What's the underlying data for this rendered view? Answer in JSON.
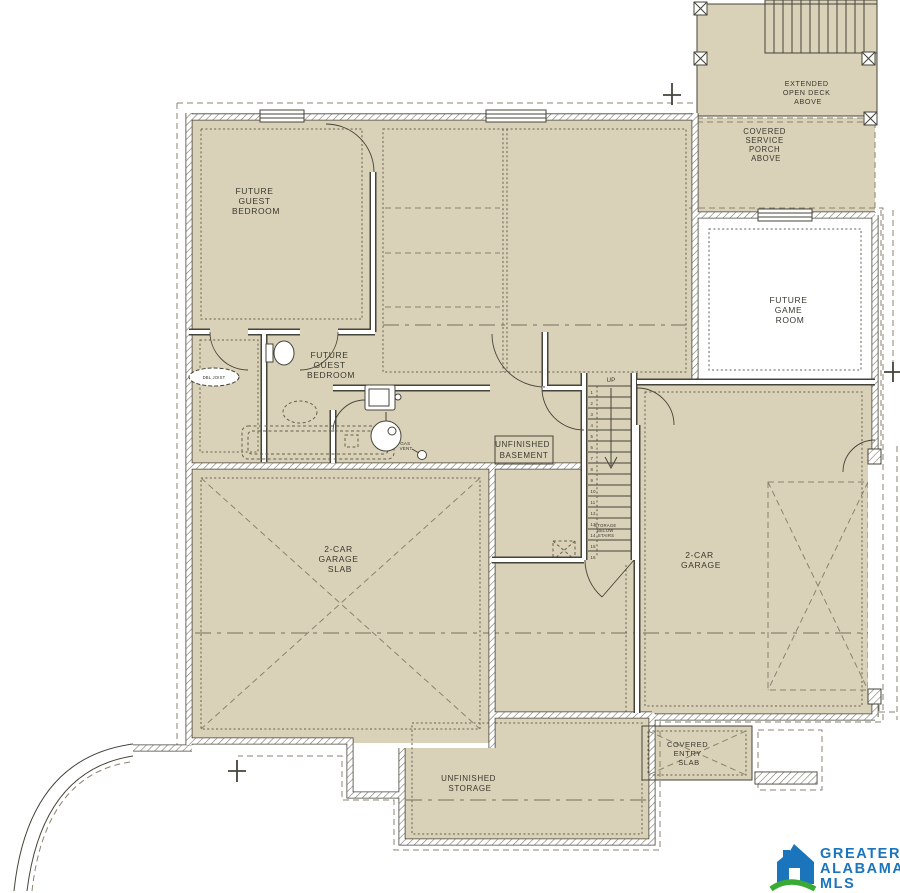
{
  "labels": {
    "guest_bedroom_upper": [
      "FUTURE",
      "GUEST",
      "BEDROOM"
    ],
    "guest_bedroom_lower": [
      "FUTURE",
      "GUEST",
      "BEDROOM"
    ],
    "unfinished_basement": [
      "UNFINISHED",
      "BASEMENT"
    ],
    "future_game_room": [
      "FUTURE",
      "GAME",
      "ROOM"
    ],
    "extended_open_deck": [
      "EXTENDED",
      "OPEN DECK",
      "ABOVE"
    ],
    "covered_service_porch": [
      "COVERED",
      "SERVICE",
      "PORCH",
      "ABOVE"
    ],
    "garage_slab": [
      "2-CAR",
      "GARAGE",
      "SLAB"
    ],
    "garage_right": [
      "2-CAR",
      "GARAGE"
    ],
    "unfinished_storage": [
      "UNFINISHED",
      "STORAGE"
    ],
    "covered_entry_slab": [
      "COVERED",
      "ENTRY",
      "SLAB"
    ],
    "storage_below_stairs": [
      "STORAGE",
      "BELOW",
      "STAIRS"
    ],
    "up": "UP",
    "dbl_joist": "DBL JOIST",
    "gas_vent": [
      "GAS",
      "VENT"
    ]
  },
  "stairs": {
    "tread_numbers": [
      "1",
      "2",
      "3",
      "4",
      "5",
      "6",
      "7",
      "8",
      "9",
      "10",
      "11",
      "12",
      "13",
      "14",
      "15",
      "16"
    ]
  },
  "logo": {
    "name": "Greater Alabama MLS",
    "lines": [
      "GREATER",
      "ALABAMA",
      "MLS"
    ]
  },
  "colors": {
    "floor": "#DAD2B8",
    "wall": "#45443A",
    "dash": "#8B8270",
    "dot": "#64604F",
    "ink": "#3A382E",
    "logo_blue": "#1B75BC",
    "logo_green": "#3BAA35"
  }
}
